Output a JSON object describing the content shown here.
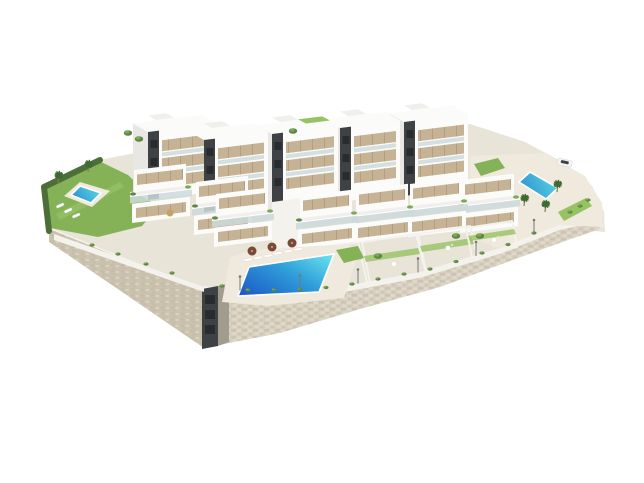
{
  "scene": {
    "kind": "3d-architectural-render",
    "description": "Aerial isometric 3D rendering of a modern white residential apartment complex built on a terraced hillside plot with a beige natural-stone retaining wall, communal and private swimming pools, lawned gardens, palm trees and landscaped promenade, isolated on a plain white studio background.",
    "background": "plain white",
    "camera": "high-angle aerial isometric view",
    "elements": [
      "beige natural-stone retaining wall wrapping the lower edge of the plot",
      "dark service/stair shaft embedded in the wall corner",
      "five tall white apartment blocks with dark stair cores, tan window strips and glass balconies (back row)",
      "seven stepped terraced duplex units with glass railings and planters (front row)",
      "communal lawn garden with plunge pool, sun loungers and palm trees (left)",
      "large communal swimming pool with sun loungers and brown parasols (center)",
      "upper deck pool area with palm trees and a parked white car (right)",
      "four private lawned gardens with patio tables and small trees (right front)",
      "promenade edge with shrubs and street lamps along the retaining wall"
    ]
  },
  "inventory": {
    "apartment_blocks_back_row": 5,
    "terraced_units_front_row": 7,
    "swimming_pools": 3,
    "private_gardens": 4,
    "communal_gardens": 1,
    "palm_trees": 5,
    "parasols": 4,
    "sun_loungers": 9,
    "street_lamps": 6,
    "cars": 1
  },
  "colors": {
    "background": "#ffffff",
    "terrain": "#e9e4d8",
    "stone_base": "#d7d0c1",
    "stone_dark": "#c0b49d",
    "stone_light": "#e8e2d3",
    "stone_side": "#cbc3b0",
    "shaft_concrete": "#a29c8f",
    "wall_white": "#f4f2ec",
    "building_white": "#fbfbfa",
    "building_side": "#e8e7e3",
    "building_slab": "#f1efec",
    "window_tan": "#c6b294",
    "window_frame": "#a58e6b",
    "core_dark": "#3f4245",
    "core_window": "#292c2e",
    "glass": "#cdd9dc",
    "deck": "#efeadd",
    "grass": "#85b257",
    "grass_light": "#97c264",
    "hedge": "#4c6e39",
    "tree": "#5d8743",
    "tree_light": "#7aa855",
    "palm_green": "#3f6b33",
    "pool_deep": "#1d5dc9",
    "pool_mid": "#2f9fd8",
    "pool_light": "#66dff0",
    "pool_small_deep": "#2f8fd0",
    "pool_small_light": "#57d5e4",
    "parasol_brown": "#7b4a36",
    "parasol_tan": "#c8a06a",
    "car_white": "#f4f4f2",
    "car_window": "#3c4246",
    "lamp_grey": "#777777",
    "lounger_white": "#ffffff"
  }
}
